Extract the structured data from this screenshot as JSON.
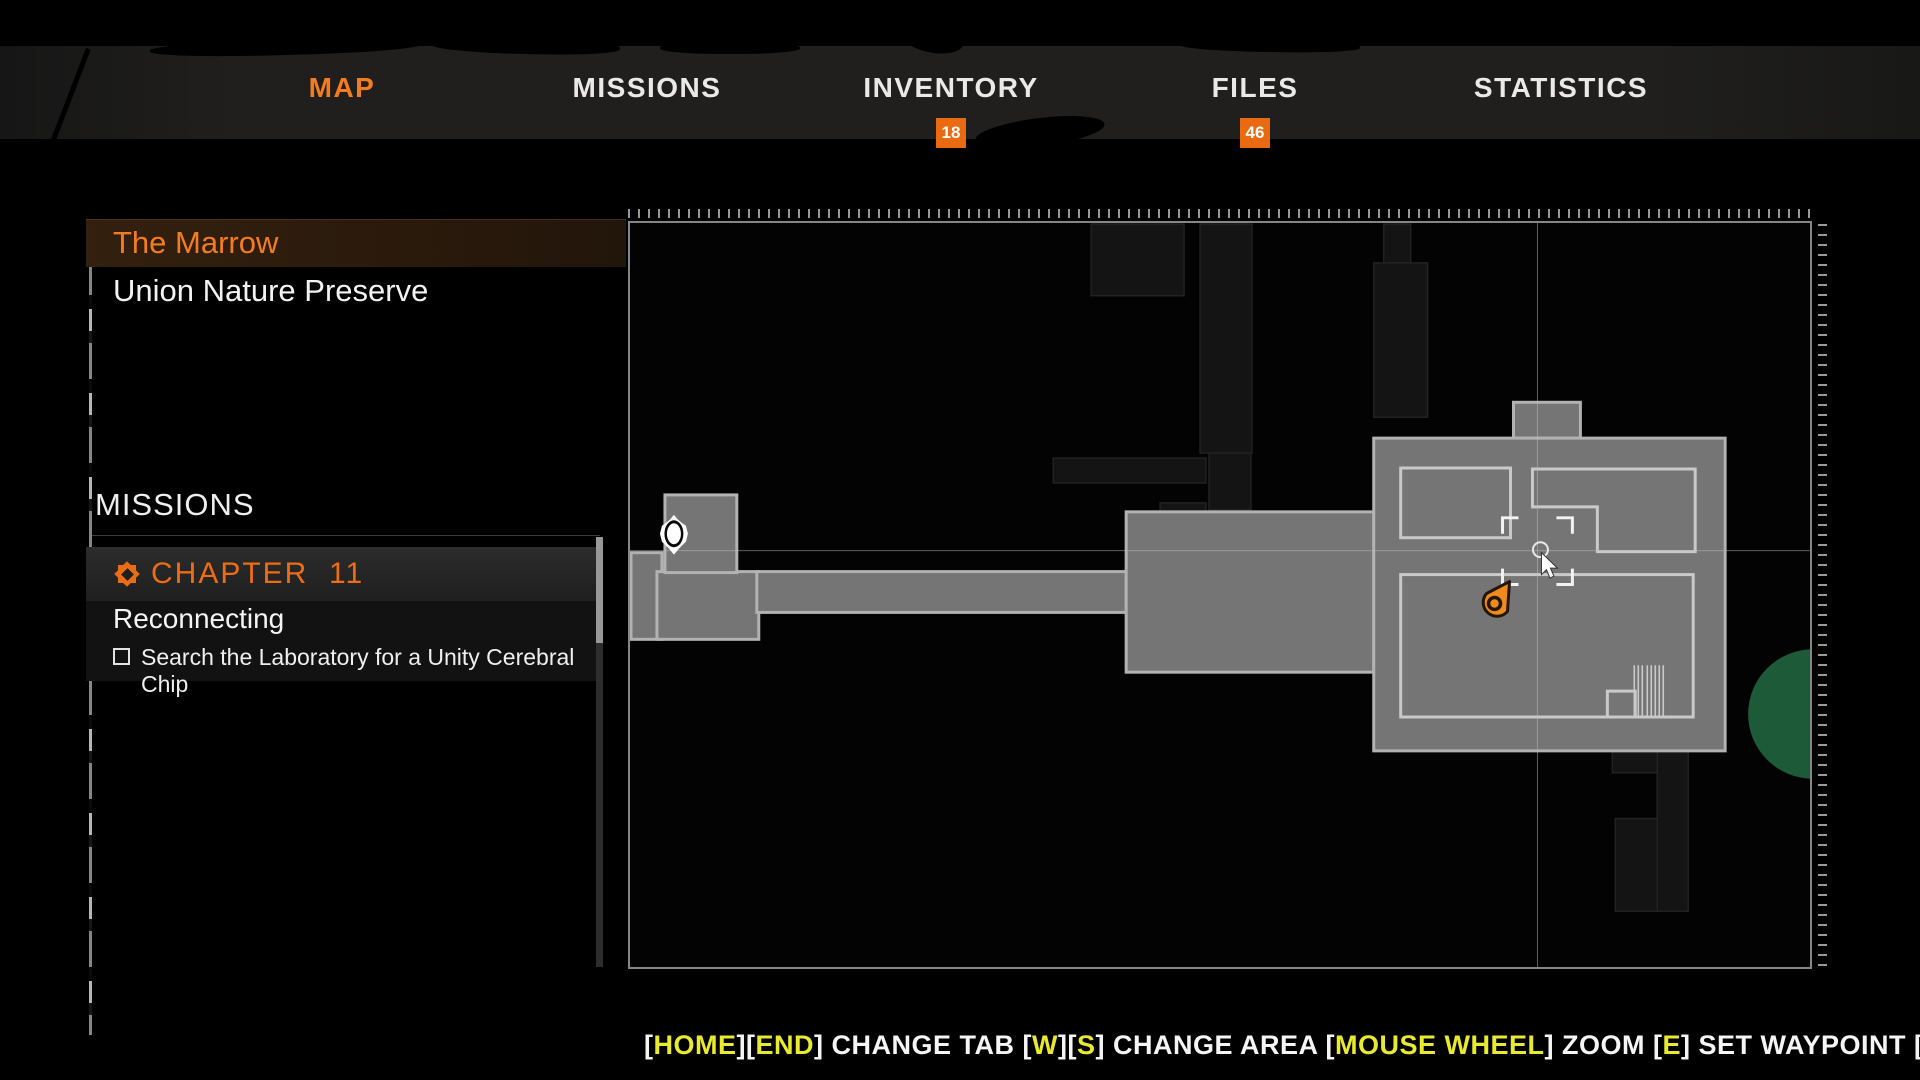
{
  "colors": {
    "accent": "#f47c20",
    "key_yellow": "#e9ea2e",
    "badge_orange": "#ea6a12",
    "room_gray": "#757575",
    "room_border": "#b2b2b2",
    "green_zone": "#1d5a37"
  },
  "nav": {
    "items": [
      {
        "label": "MAP",
        "active": true
      },
      {
        "label": "MISSIONS",
        "active": false
      },
      {
        "label": "INVENTORY",
        "active": false,
        "badge": "18"
      },
      {
        "label": "FILES",
        "active": false,
        "badge": "46"
      },
      {
        "label": "STATISTICS",
        "active": false
      }
    ]
  },
  "sidebar": {
    "areas": [
      {
        "label": "The Marrow",
        "selected": true
      },
      {
        "label": "Union Nature Preserve",
        "selected": false
      }
    ],
    "missions_heading": "MISSIONS",
    "chapter": {
      "label": "CHAPTER  11"
    },
    "mission_title": "Reconnecting",
    "objective": {
      "label": "Search the Laboratory for a Unity Cerebral Chip",
      "checked": false
    }
  },
  "bottom_bar": {
    "segments": [
      {
        "t": "[",
        "k": "w"
      },
      {
        "t": "HOME",
        "k": "y"
      },
      {
        "t": "][",
        "k": "w"
      },
      {
        "t": "END",
        "k": "y"
      },
      {
        "t": "] CHANGE TAB [",
        "k": "w"
      },
      {
        "t": "W",
        "k": "y"
      },
      {
        "t": "][",
        "k": "w"
      },
      {
        "t": "S",
        "k": "y"
      },
      {
        "t": "] CHANGE AREA [",
        "k": "w"
      },
      {
        "t": "MOUSE WHEEL",
        "k": "y"
      },
      {
        "t": "] ZOOM [",
        "k": "w"
      },
      {
        "t": "E",
        "k": "y"
      },
      {
        "t": "] SET WAYPOINT [",
        "k": "w"
      },
      {
        "t": "Q",
        "k": "y"
      },
      {
        "t": "] BACK",
        "k": "w"
      }
    ]
  }
}
